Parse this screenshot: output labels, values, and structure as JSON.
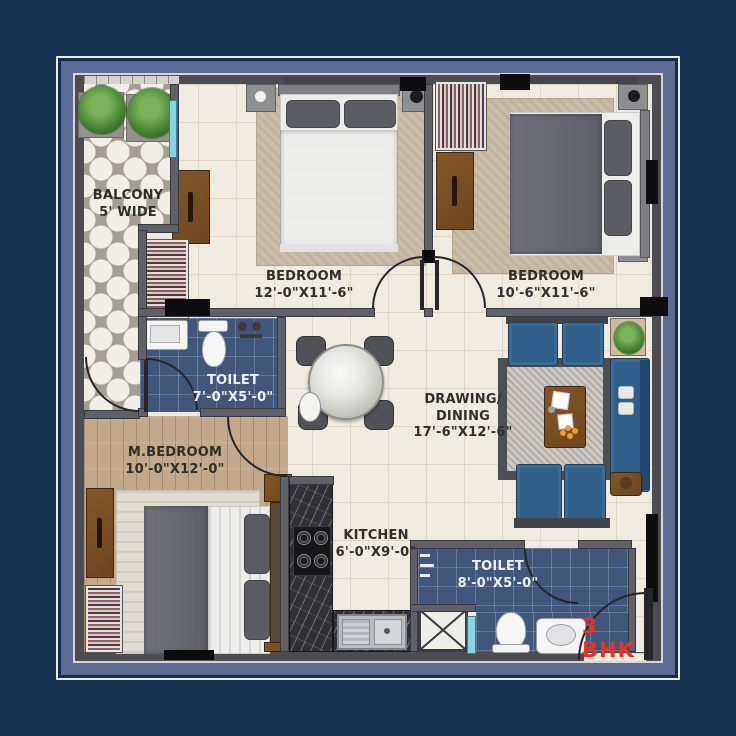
{
  "plan_type_label": "3 BHK",
  "rooms": {
    "balcony": {
      "name": "BALCONY",
      "dim": "5' WIDE"
    },
    "bedroom_left": {
      "name": "BEDROOM",
      "dim": "12'-0\"X11'-6\""
    },
    "bedroom_right": {
      "name": "BEDROOM",
      "dim": "10'-6\"X11'-6\""
    },
    "toilet_upper": {
      "name": "TOILET",
      "dim": "7'-0\"X5'-0\""
    },
    "master_bedroom": {
      "name": "M.BEDROOM",
      "dim": "10'-0\"X12'-0\""
    },
    "drawing_dining": {
      "line1": "DRAWING/",
      "line2": "DINING",
      "dim": "17'-6\"X12'-6\""
    },
    "kitchen": {
      "name": "KITCHEN",
      "dim": "6'-0\"X9'-0\""
    },
    "toilet_lower": {
      "name": "TOILET",
      "dim": "8'-0\"X5'-0\""
    }
  },
  "colors": {
    "background": "#15304f",
    "frame_band": "#5c6b94",
    "toilet_tile": "#41567b",
    "sofa_blue": "#2f5f88",
    "plan_type_red": "#e93125"
  }
}
